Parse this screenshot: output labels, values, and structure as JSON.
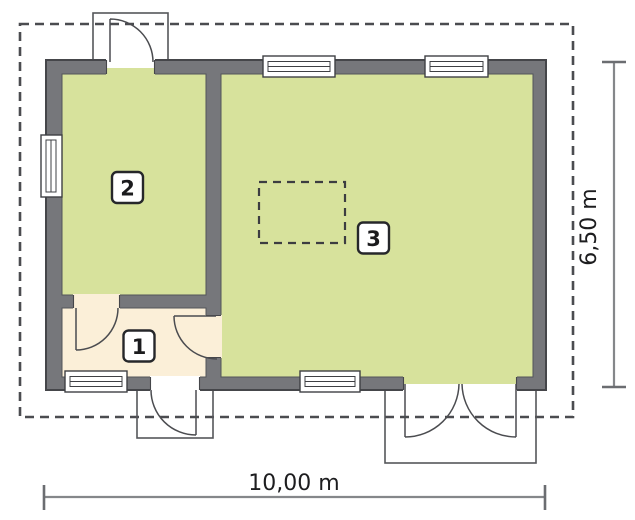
{
  "rooms": [
    {
      "number": "1"
    },
    {
      "number": "2"
    },
    {
      "number": "3"
    }
  ],
  "dimensions": {
    "width_label": "10,00 m",
    "height_label": "6,50 m"
  },
  "colors": {
    "room_green": "#d7e29c",
    "hall_cream": "#fbefd8",
    "wall_gray": "#76777b",
    "roof_outline_dash": "#4b4c50",
    "dimension_line_gray": "#85878a",
    "dimension_text": "#1d1d1f"
  }
}
